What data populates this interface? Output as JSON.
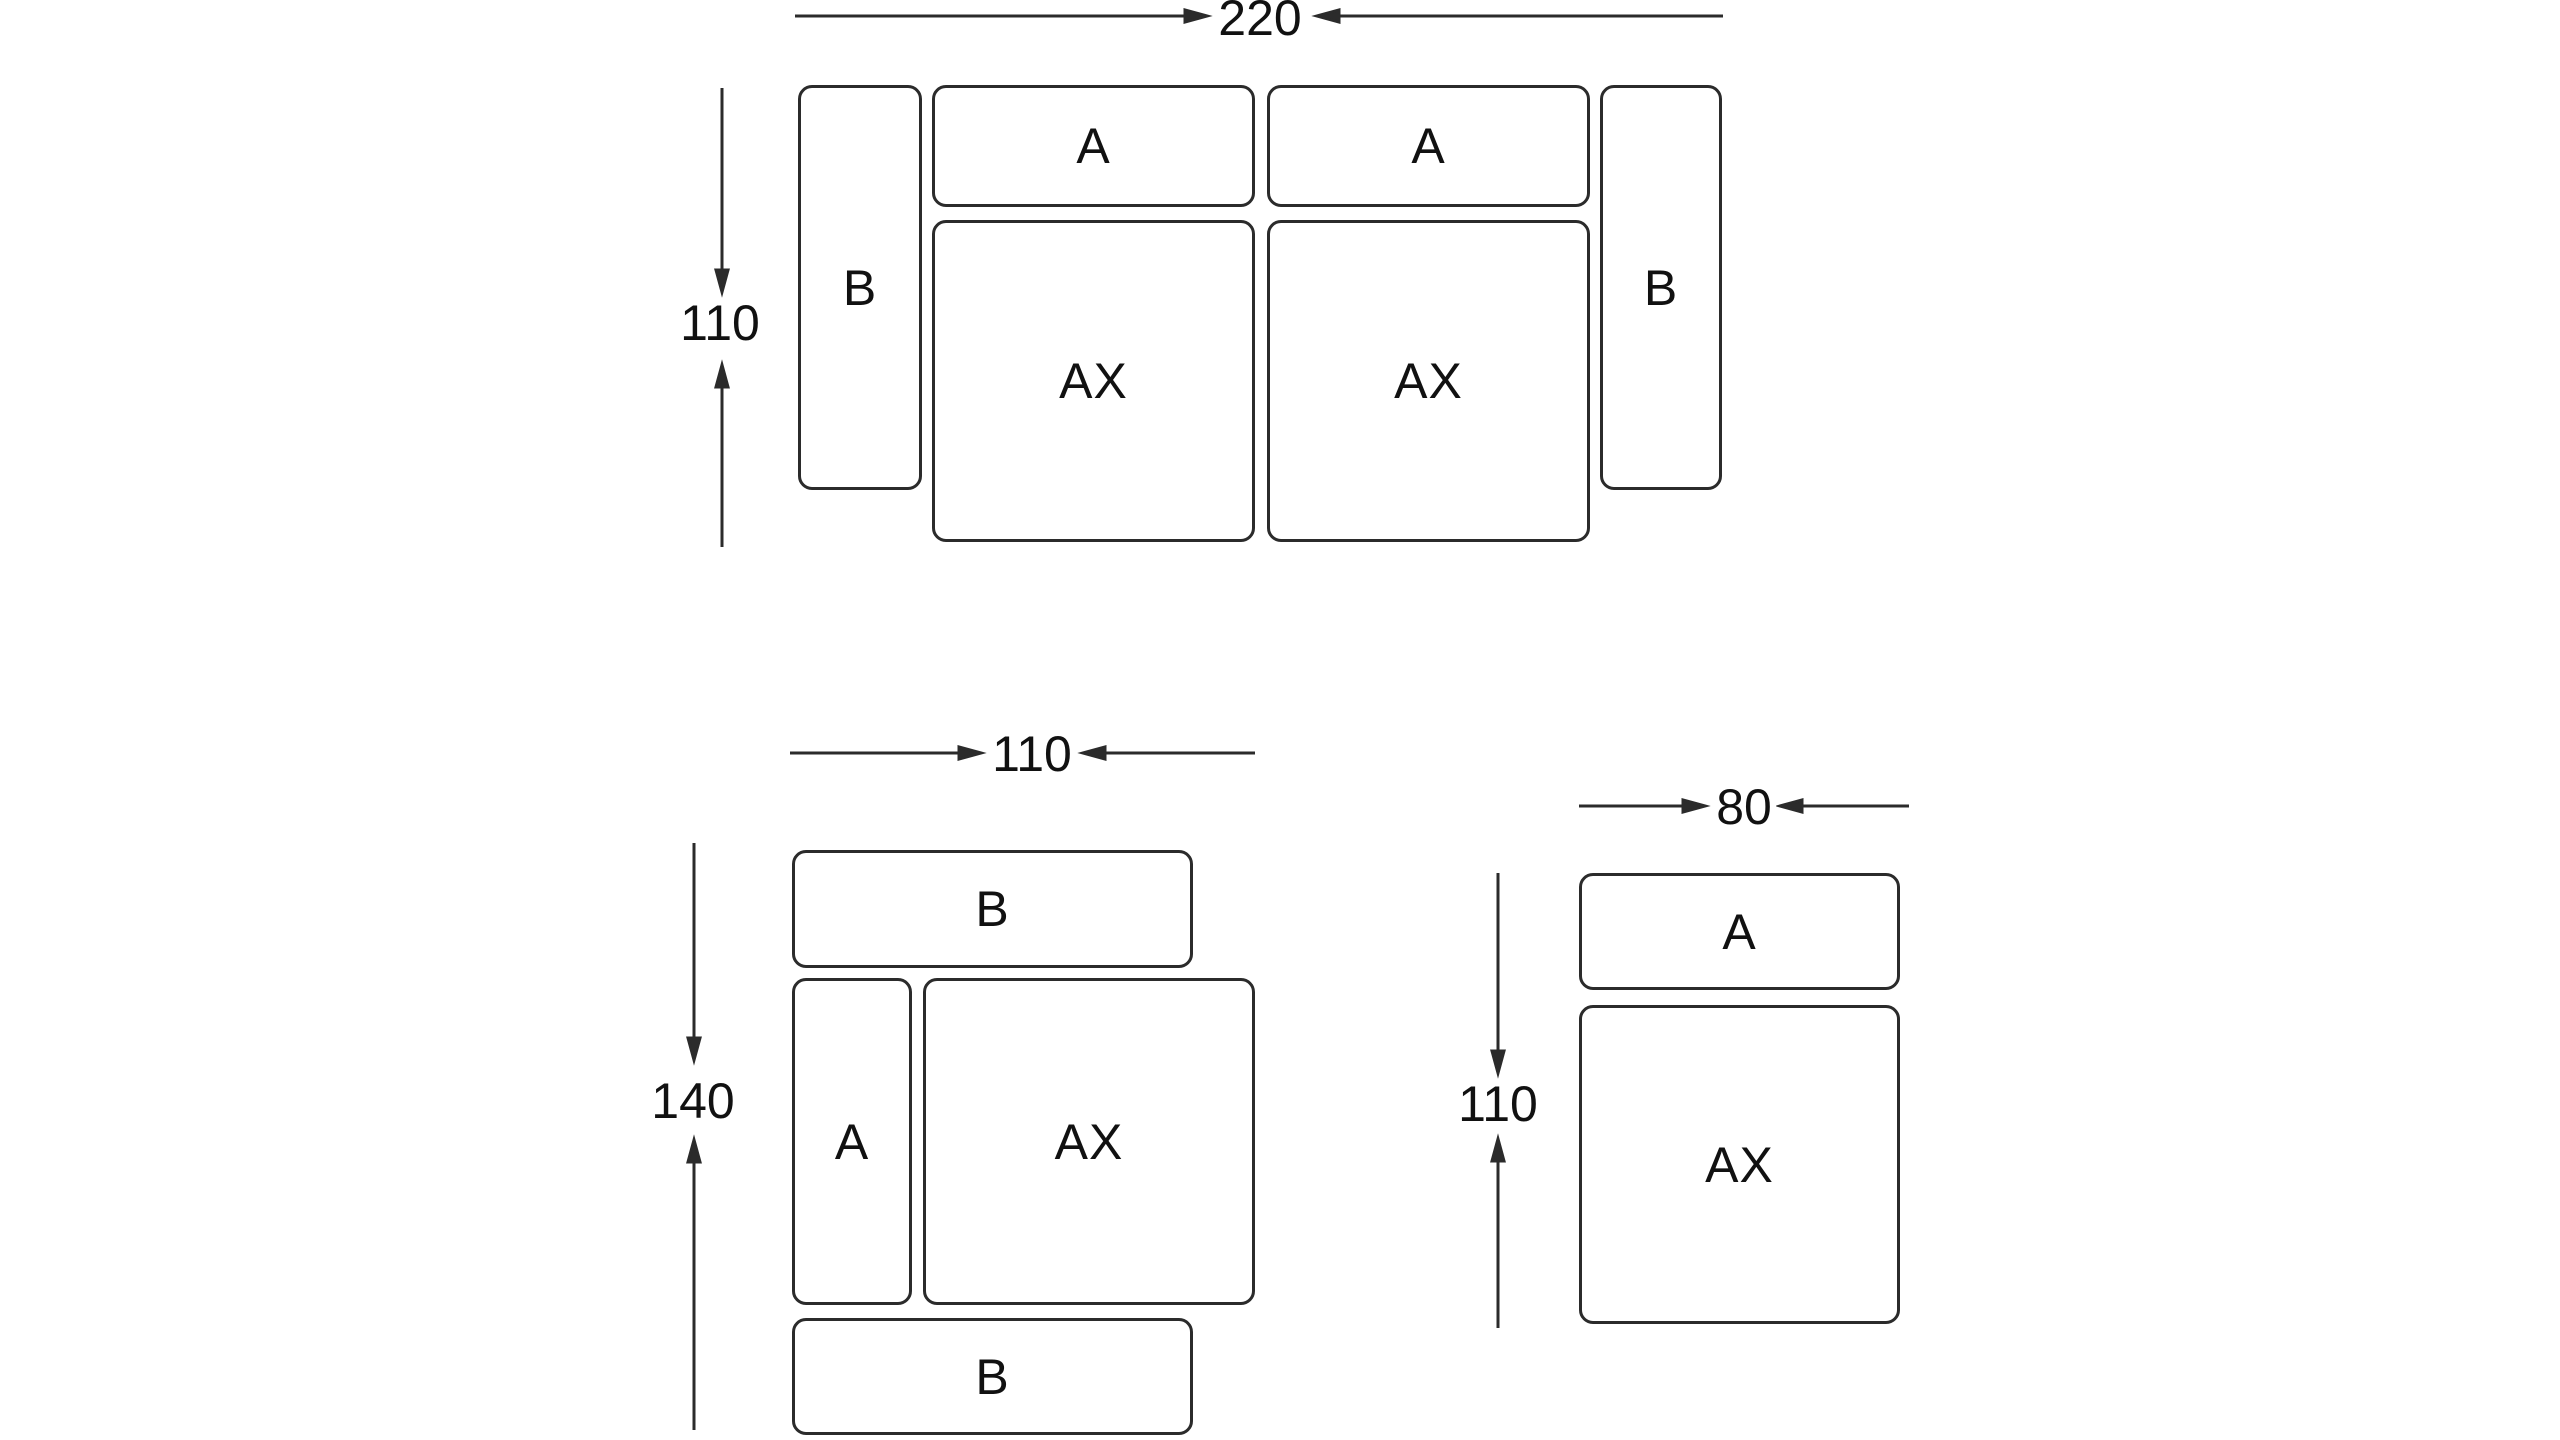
{
  "colors": {
    "background": "#ffffff",
    "line": "#2b2b2b",
    "text": "#111111"
  },
  "diagrams": [
    {
      "name": "three-seat-sofa-top-view",
      "width_label": "220",
      "height_label": "110",
      "modules": [
        {
          "label": "B"
        },
        {
          "label": "A"
        },
        {
          "label": "A"
        },
        {
          "label": "AX"
        },
        {
          "label": "AX"
        },
        {
          "label": "B"
        }
      ]
    },
    {
      "name": "armchair-with-two-armrests-top-view",
      "width_label": "110",
      "height_label": "140",
      "modules": [
        {
          "label": "B"
        },
        {
          "label": "A"
        },
        {
          "label": "AX"
        },
        {
          "label": "B"
        }
      ]
    },
    {
      "name": "single-seat-module-top-view",
      "width_label": "80",
      "height_label": "110",
      "modules": [
        {
          "label": "A"
        },
        {
          "label": "AX"
        }
      ]
    }
  ]
}
